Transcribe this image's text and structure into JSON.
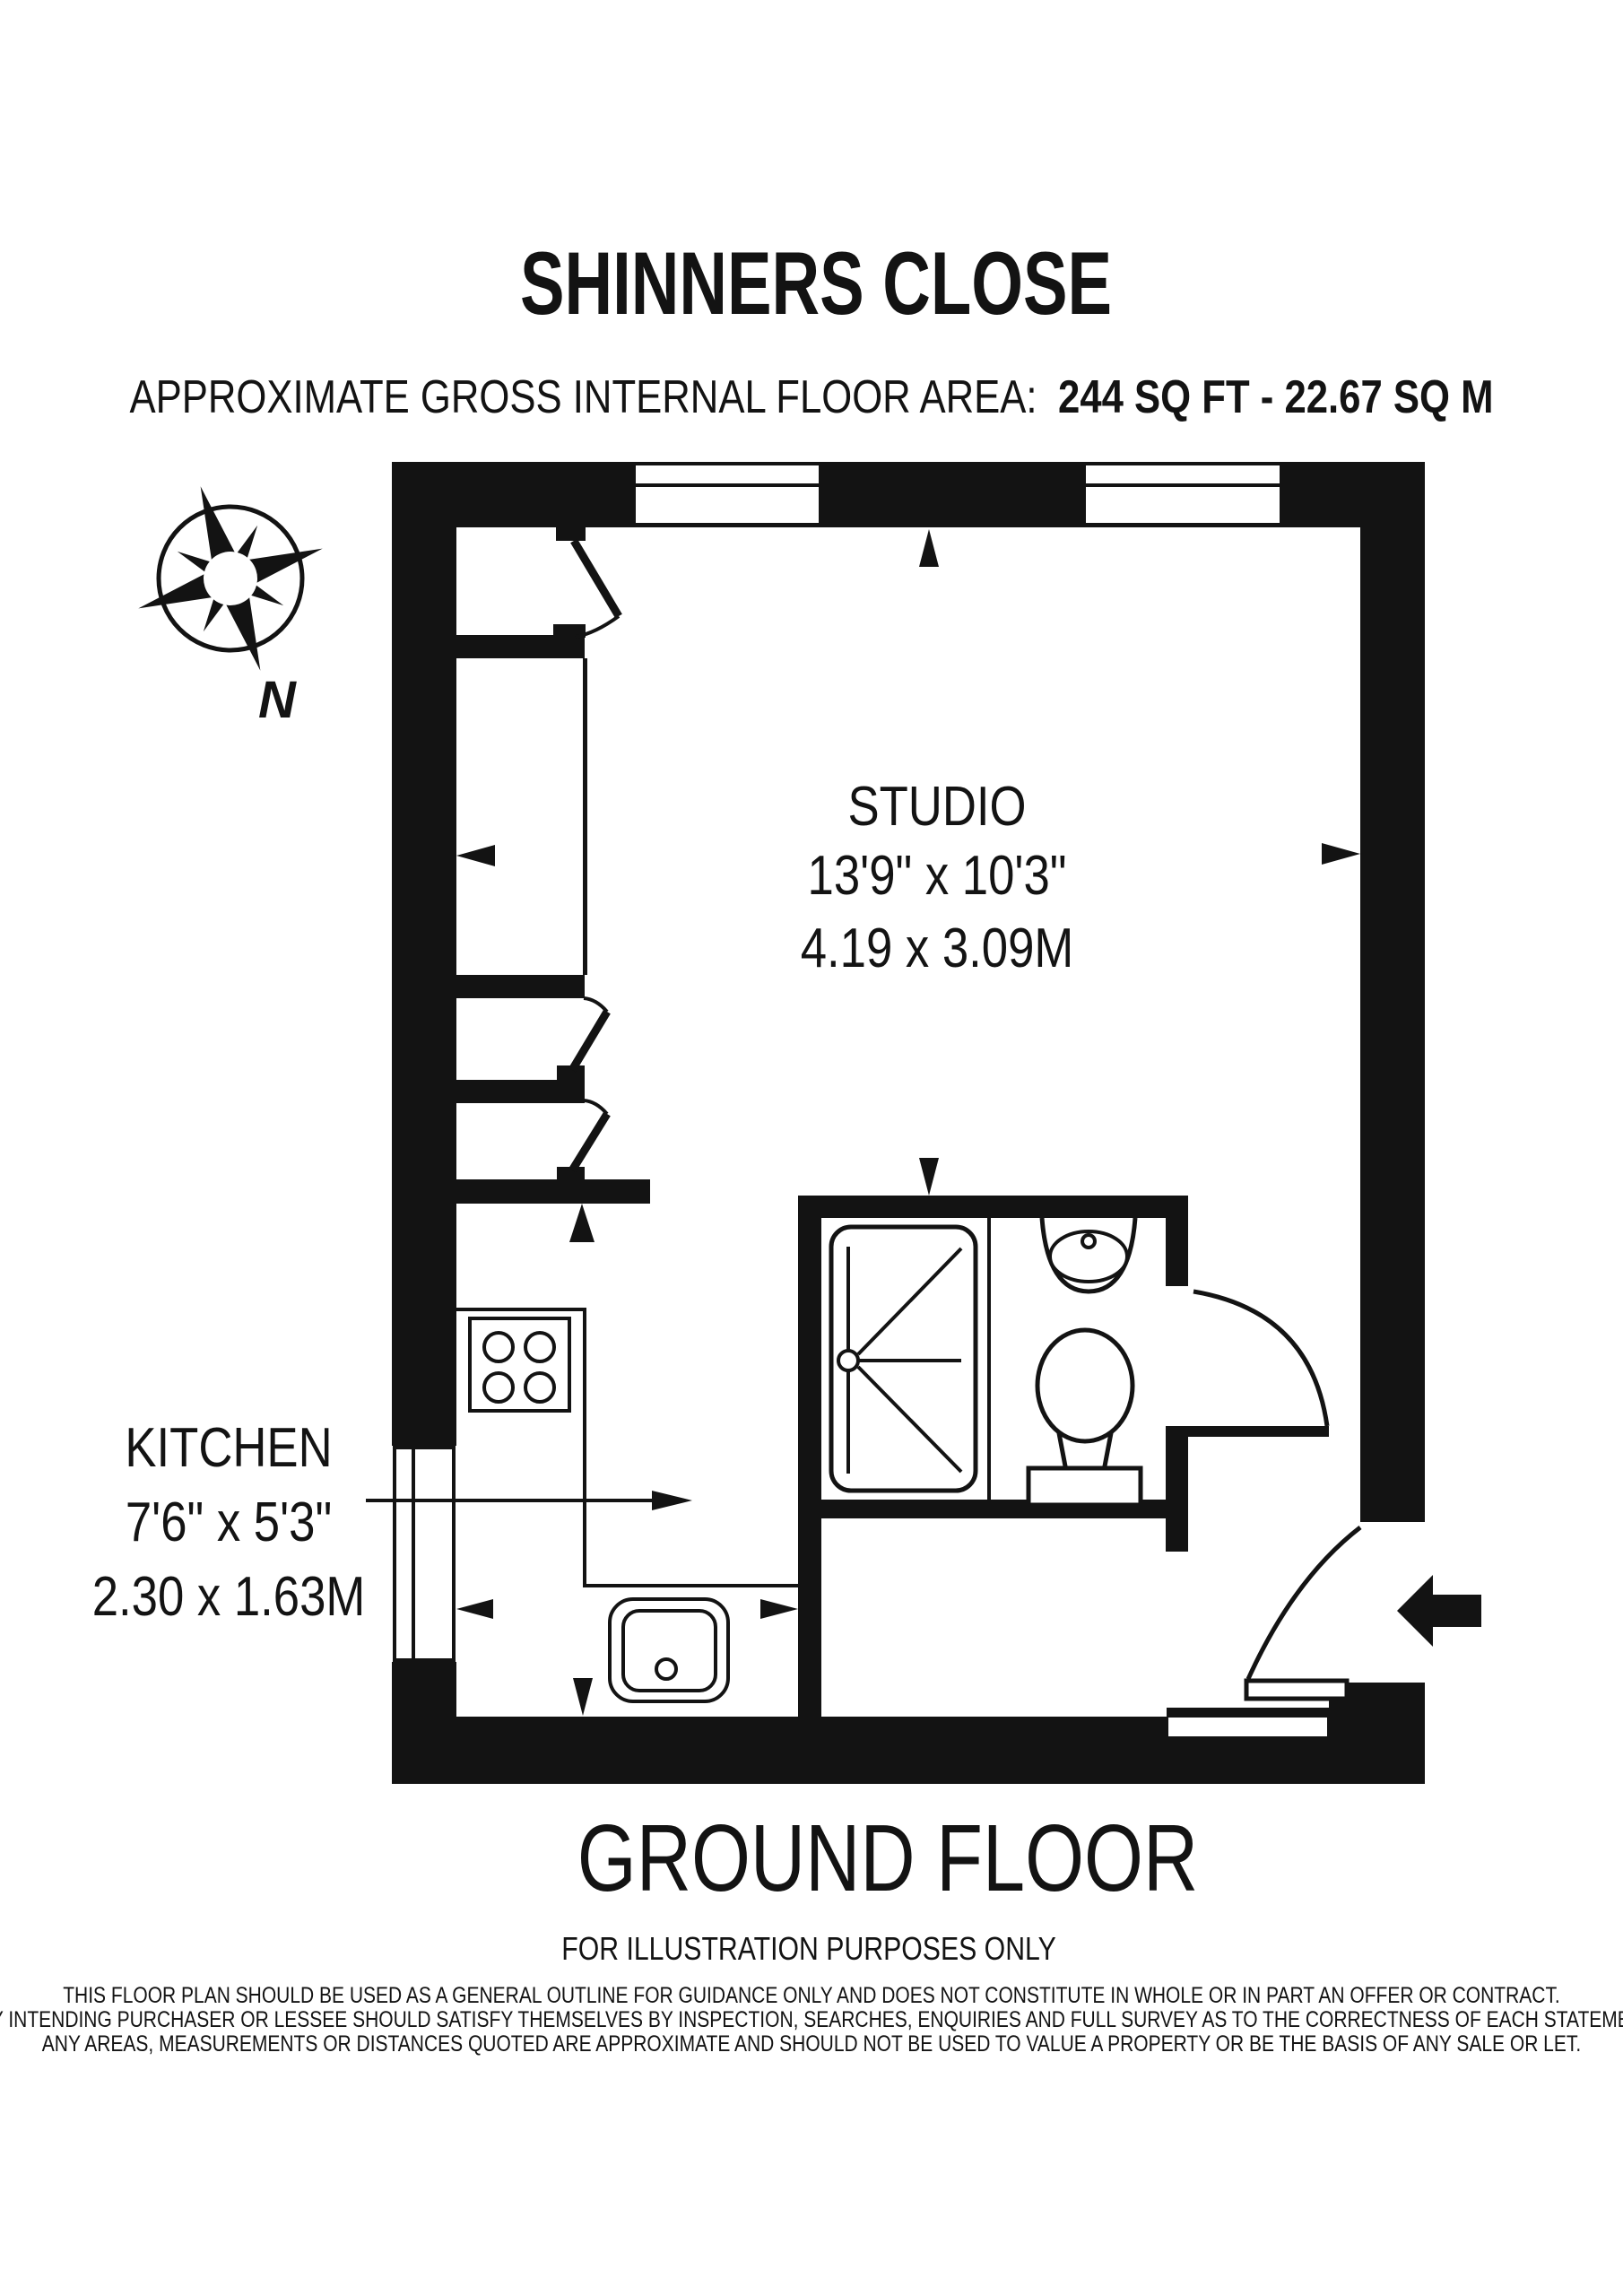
{
  "title": "SHINNERS CLOSE",
  "subtitle": {
    "label": "APPROXIMATE GROSS INTERNAL FLOOR AREA:",
    "value": "244 SQ FT - 22.67 SQ M"
  },
  "compass": {
    "north": "N"
  },
  "rooms": {
    "studio": {
      "name": "STUDIO",
      "imperial": "13'9\" x 10'3\"",
      "metric": "4.19 x 3.09M"
    },
    "kitchen": {
      "name": "KITCHEN",
      "imperial": "7'6\" x 5'3\"",
      "metric": "2.30 x 1.63M"
    }
  },
  "footer": {
    "floor_label": "GROUND FLOOR",
    "note": "FOR ILLUSTRATION PURPOSES ONLY"
  },
  "disclaimer": {
    "lines": [
      "THIS FLOOR PLAN SHOULD BE USED AS A GENERAL OUTLINE FOR GUIDANCE ONLY AND DOES NOT CONSTITUTE IN WHOLE OR IN PART AN OFFER OR CONTRACT.",
      "ANY INTENDING PURCHASER OR LESSEE SHOULD SATISFY THEMSELVES BY INSPECTION, SEARCHES, ENQUIRIES AND FULL SURVEY AS TO THE CORRECTNESS OF EACH STATEMENT.",
      "ANY AREAS, MEASUREMENTS OR DISTANCES QUOTED ARE APPROXIMATE AND SHOULD NOT BE USED TO VALUE A PROPERTY OR BE THE BASIS OF ANY SALE OR LET."
    ]
  }
}
